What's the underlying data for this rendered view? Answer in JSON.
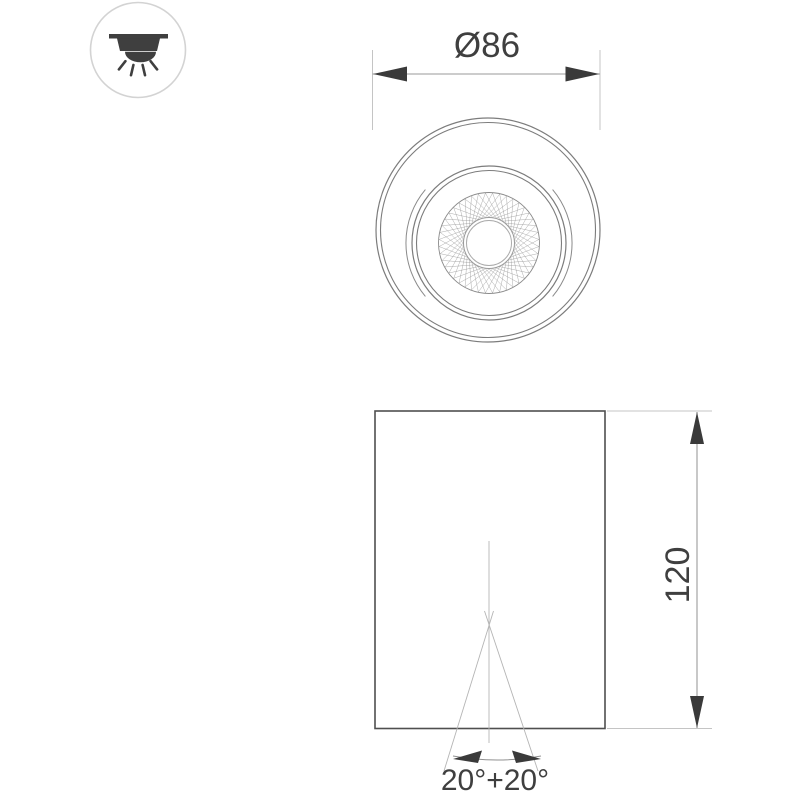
{
  "drawing": {
    "type": "luminaire-dimension-drawing",
    "top_view": {
      "diameter_label": "Ø86"
    },
    "side_view": {
      "height_label": "120",
      "beam_angle_label": "20°+20°"
    }
  },
  "legend": {
    "icon": "ceiling-mount-light-icon"
  },
  "colors": {
    "background": "#ffffff",
    "outline": "#7c7c7c",
    "body_outline": "#4f4f4f",
    "dimension_line": "#9a9a9a",
    "extension_line": "#c4c4c4",
    "thin_construction_line": "#b5b5b5",
    "arrowhead": "#3a3a3a",
    "text": "#3f3f3f",
    "icon_glyph": "#3f3f3f",
    "icon_circle_border": "#d3d3d3",
    "mesh": "#909090"
  }
}
